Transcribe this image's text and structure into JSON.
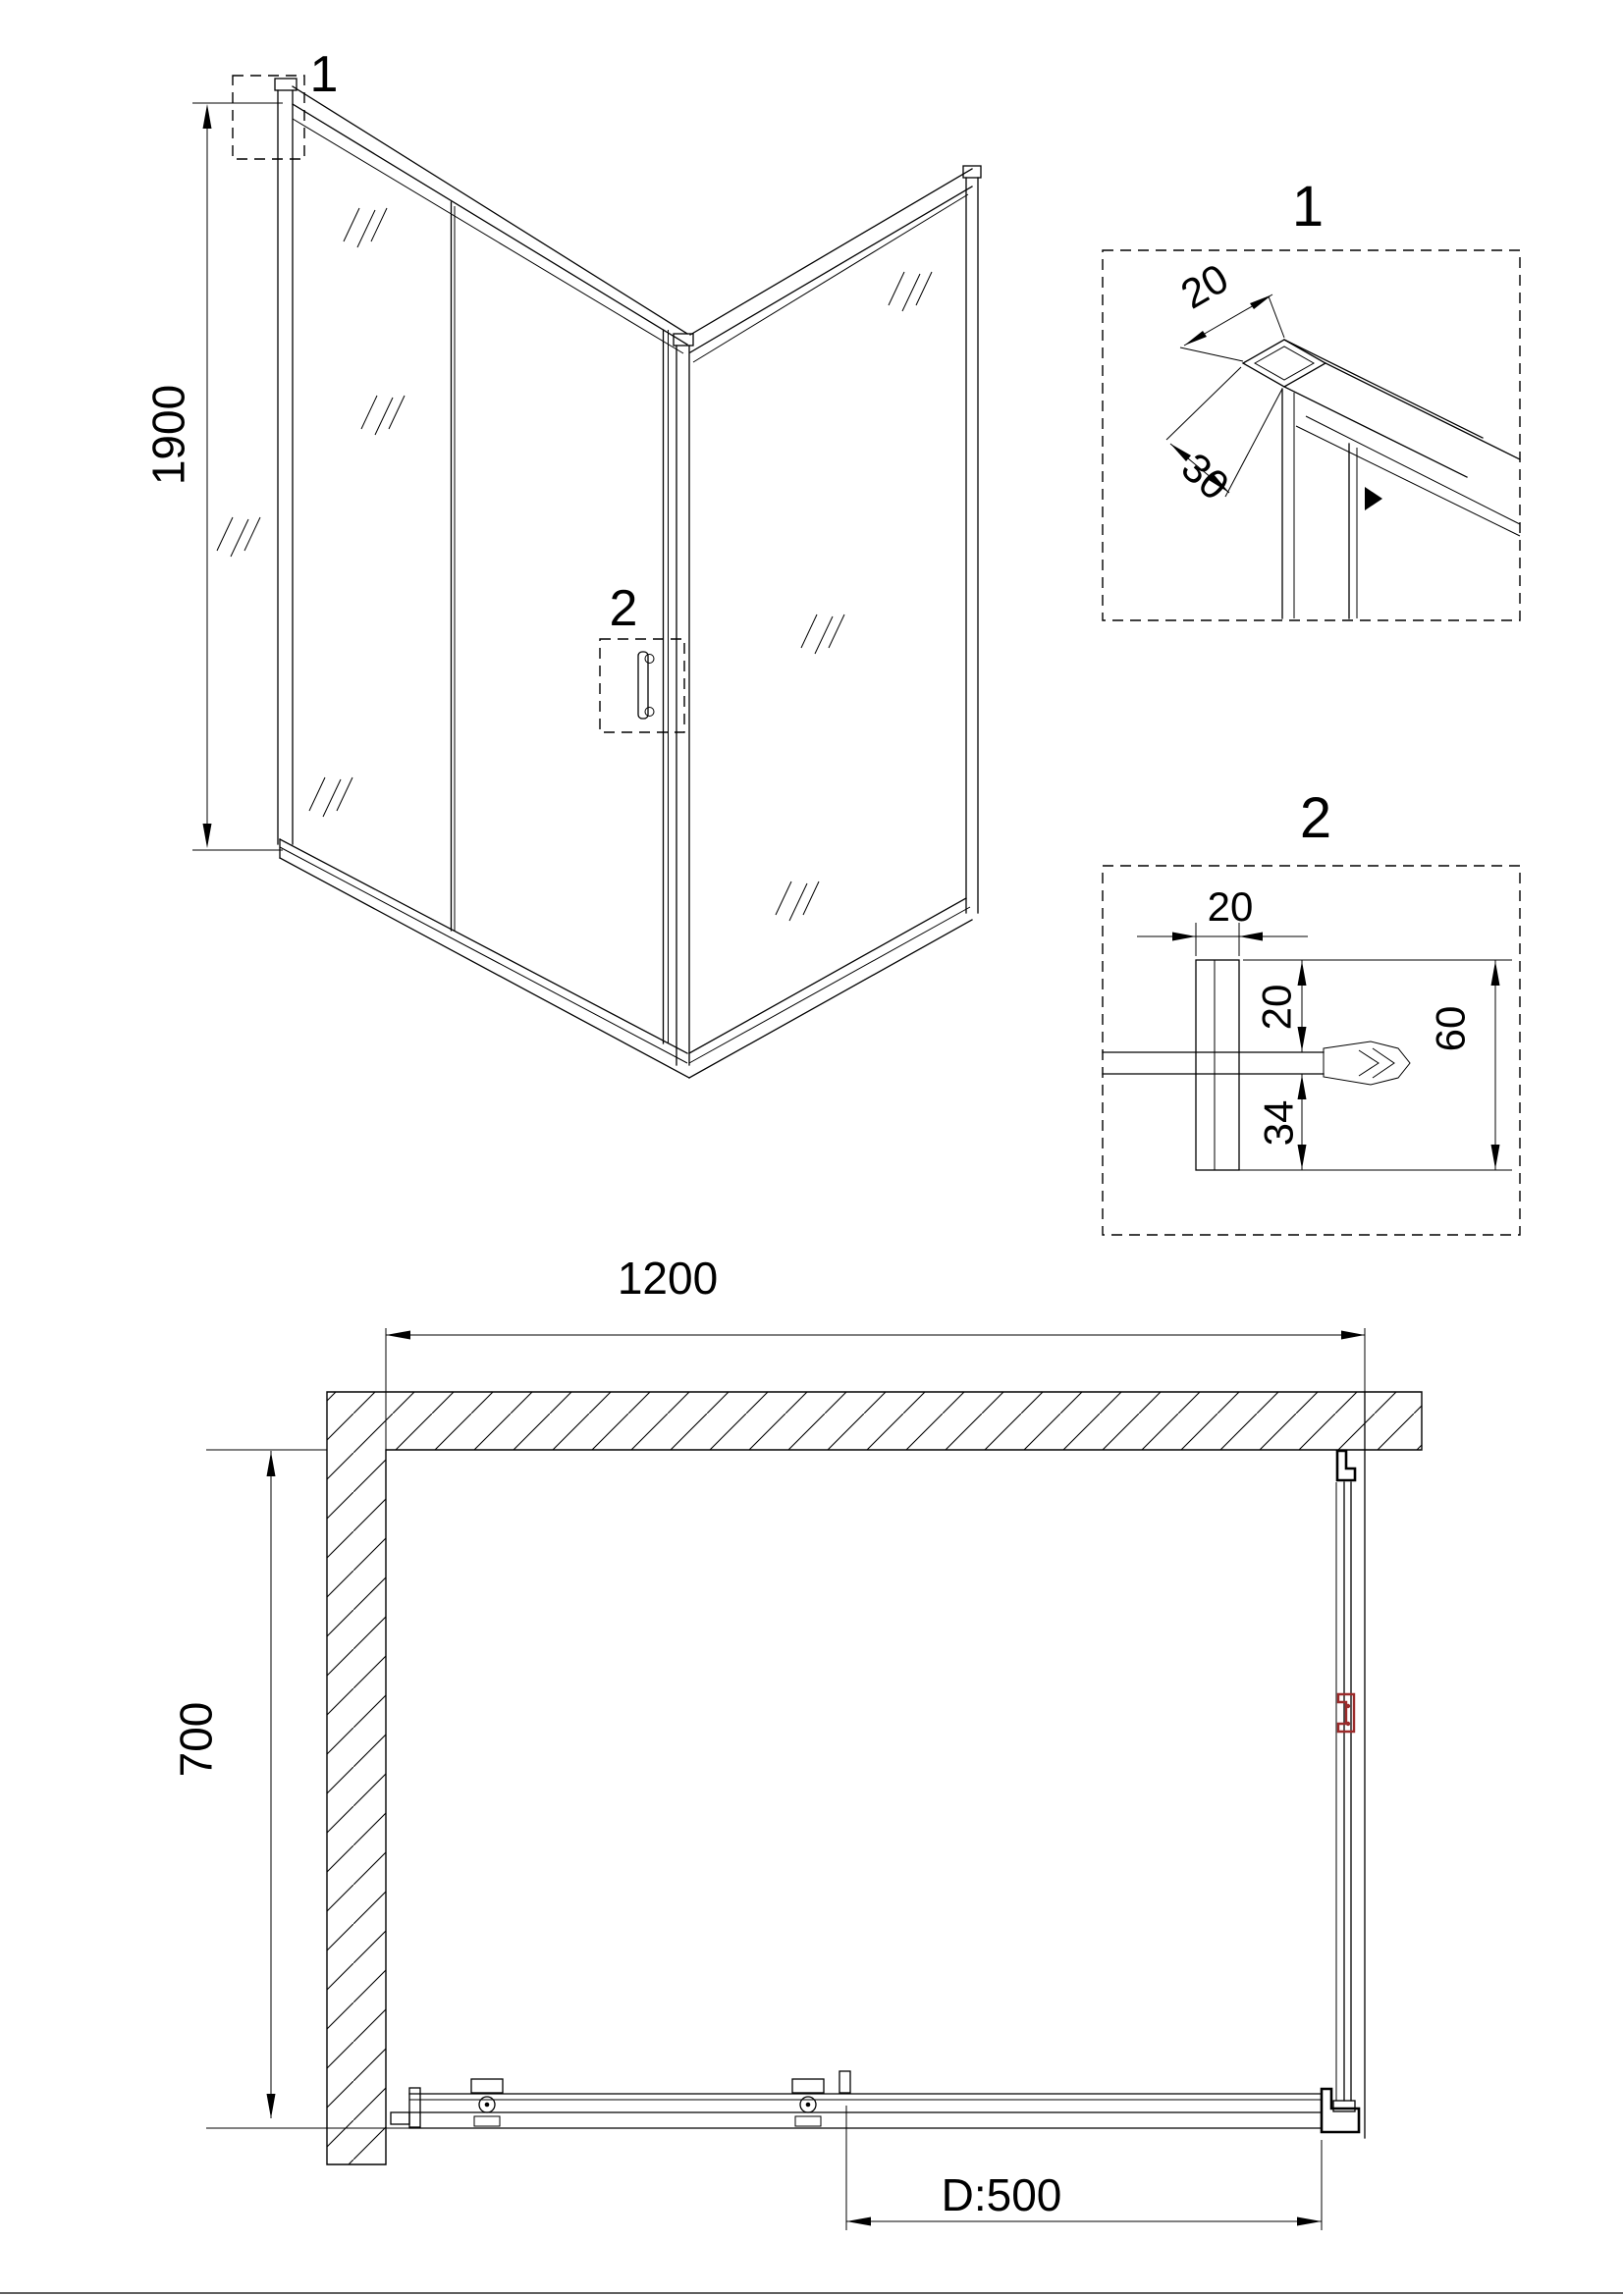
{
  "front_view": {
    "height_dim": "1900",
    "callout_top": "1",
    "callout_handle": "2"
  },
  "detail_1": {
    "label": "1",
    "dim_width": "20",
    "dim_depth": "30"
  },
  "detail_2": {
    "label": "2",
    "dim_profile_width": "20",
    "dim_glass_inset": "20",
    "dim_lower": "34",
    "dim_overall": "60"
  },
  "plan_view": {
    "width_dim": "1200",
    "depth_dim": "700",
    "door_dim": "D:500"
  },
  "colors": {
    "line": "#000000",
    "red_accent": "#9c2b2b"
  }
}
